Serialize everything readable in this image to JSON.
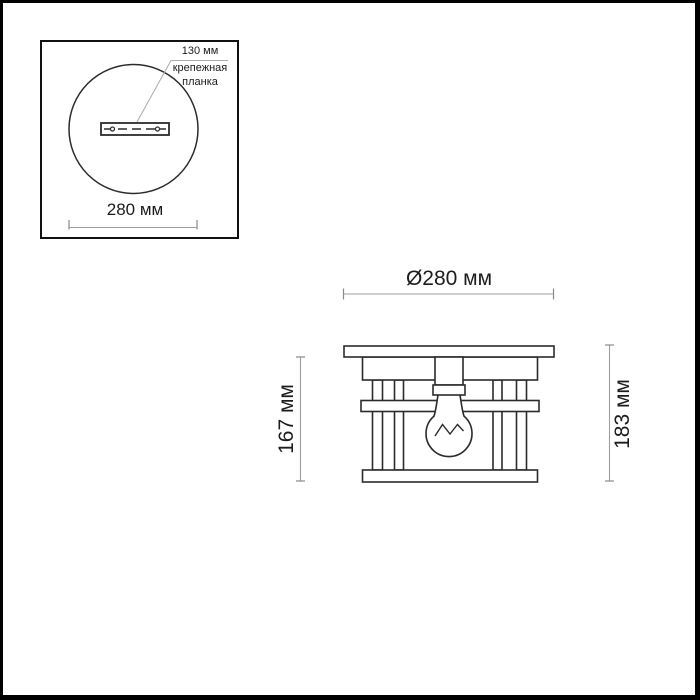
{
  "colors": {
    "line": "#2b2b2b",
    "dim_line": "#9e9e9e",
    "text": "#1c1c1c",
    "background": "#ffffff",
    "frame_border": "#000000"
  },
  "inset_top_view": {
    "mount_plate_size": "130 мм",
    "mount_plate_name": "крепежная\nпланка",
    "diameter": "280 мм"
  },
  "front_view": {
    "diameter": "Ø280 мм",
    "height_without_canopy": "167 мм",
    "height_total": "183 мм"
  }
}
